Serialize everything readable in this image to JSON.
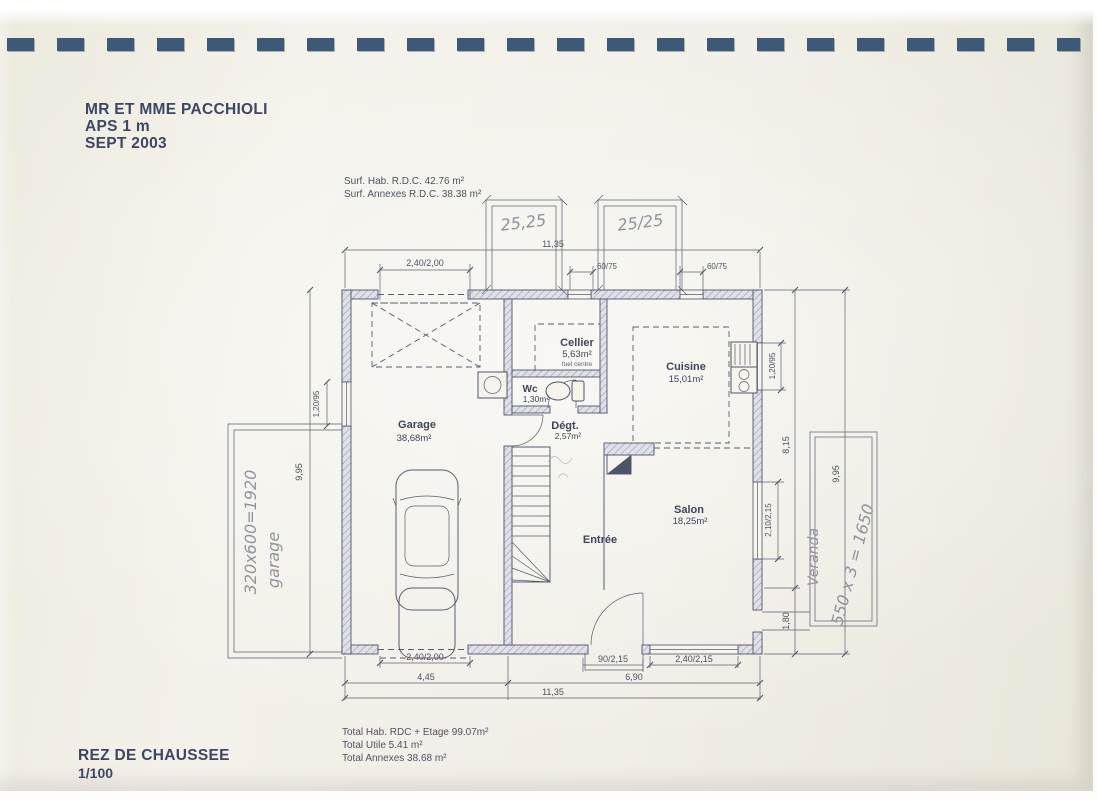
{
  "colors": {
    "paper": "#f1eee6",
    "ink": "#4e5569",
    "binding": "#3e5877",
    "pencil": "#8f93a2"
  },
  "header": {
    "client": "MR ET MME PACCHIOLI",
    "phase": "APS 1 m",
    "date": "SEPT 2003"
  },
  "surface_notes": {
    "hab": "Surf. Hab. R.D.C. 42.76 m²",
    "annexes": "Surf. Annexes R.D.C. 38.38 m²"
  },
  "plan": {
    "rooms": {
      "garage": {
        "name": "Garage",
        "area": "38,68m²"
      },
      "cellier": {
        "name": "Cellier",
        "area": "5,63m²",
        "note": "fuel centre"
      },
      "wc": {
        "name": "Wc",
        "area": "1,30m²"
      },
      "cuisine": {
        "name": "Cuisine",
        "area": "15,01m²"
      },
      "degagement": {
        "name": "Dégt.",
        "area": "2,57m²"
      },
      "salon": {
        "name": "Salon",
        "area": "18,25m²"
      },
      "entree": {
        "name": "Entrée"
      }
    },
    "dimensions": {
      "top_overall": "11,35",
      "garage_door_top": "2,40/2,00",
      "roof_window_1": "60/75",
      "roof_window_2": "60/75",
      "left_overall": "9,95",
      "garage_window": "1,20/95",
      "kitchen_window": "1,20/95",
      "right_upper": "8,15",
      "right_overall": "9,95",
      "salon_window_right": "2,10/2,15",
      "right_lower": "1,80",
      "garage_door_bottom": "2,40/2,00",
      "entry_door": "90/2,15",
      "salon_window_bottom": "2,40/2,15",
      "bottom_garage": "4,45",
      "bottom_living": "6,90",
      "bottom_overall": "11,35"
    },
    "handwritten": {
      "roof_box_left": "25,25",
      "roof_box_right": "25/25",
      "terrace_calc": "320x600=1920",
      "terrace_word": "garage",
      "veranda_word": "Veranda",
      "veranda_calc": "550 x 3 = 1650"
    }
  },
  "totals": {
    "hab": "Total Hab. RDC + Etage 99.07m²",
    "utile": "Total Utile 5.41 m²",
    "annexes": "Total Annexes 38.68 m²"
  },
  "footer": {
    "title": "REZ DE CHAUSSEE",
    "scale": "1/100"
  }
}
